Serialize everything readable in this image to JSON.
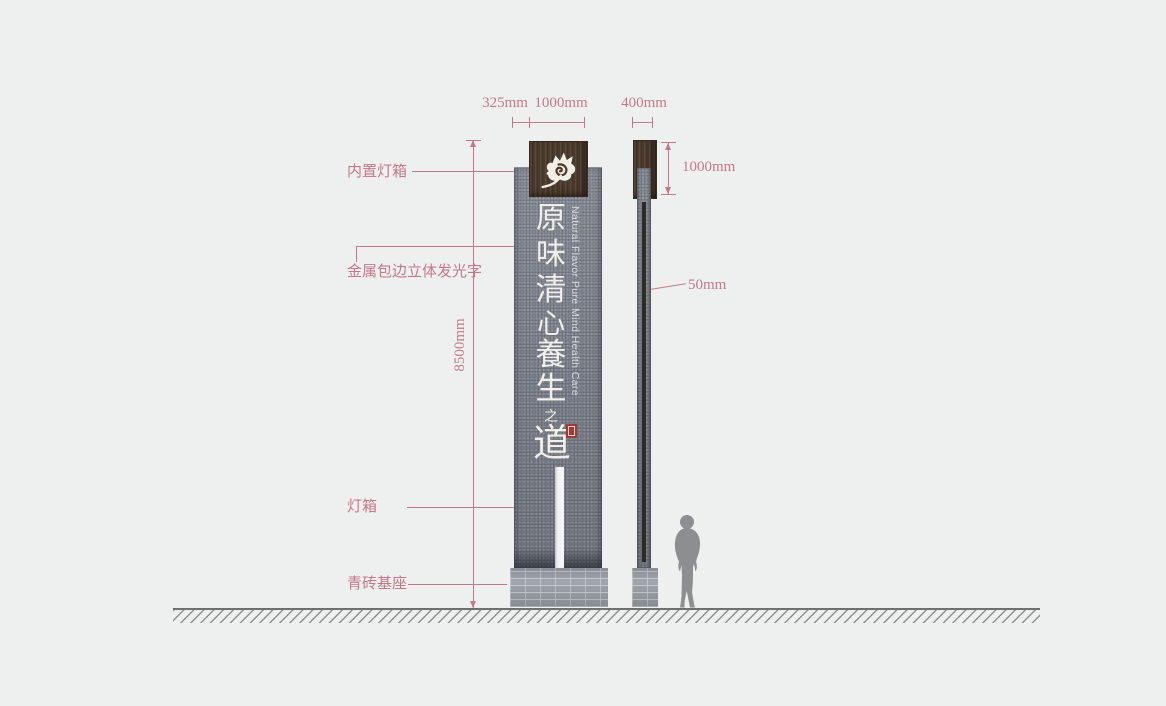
{
  "colors": {
    "background": "#eef0f0",
    "annotation_rose": "#c4798a",
    "sign_gray": "#7a7f89",
    "wood_brown": "#4c3b2c",
    "brick_gray": "#a3a9b0",
    "seal_red": "#9e3b33"
  },
  "dims": {
    "front_side_offset": "325mm",
    "front_logo_width": "1000mm",
    "side_width": "400mm",
    "logo_height": "1000mm",
    "total_height": "8500mm",
    "panel_gap": "50mm"
  },
  "callouts": {
    "builtin_lightbox": "内置灯箱",
    "metal_trim_luminous_letters": "金属包边立体发光字",
    "lightbox": "灯箱",
    "brick_base": "青砖基座"
  },
  "sign": {
    "english_text": "Natural Flavor Pure Mind Health Care",
    "calligraphy": [
      "原",
      "味",
      "清",
      "心",
      "養",
      "生",
      "之",
      "道"
    ]
  }
}
